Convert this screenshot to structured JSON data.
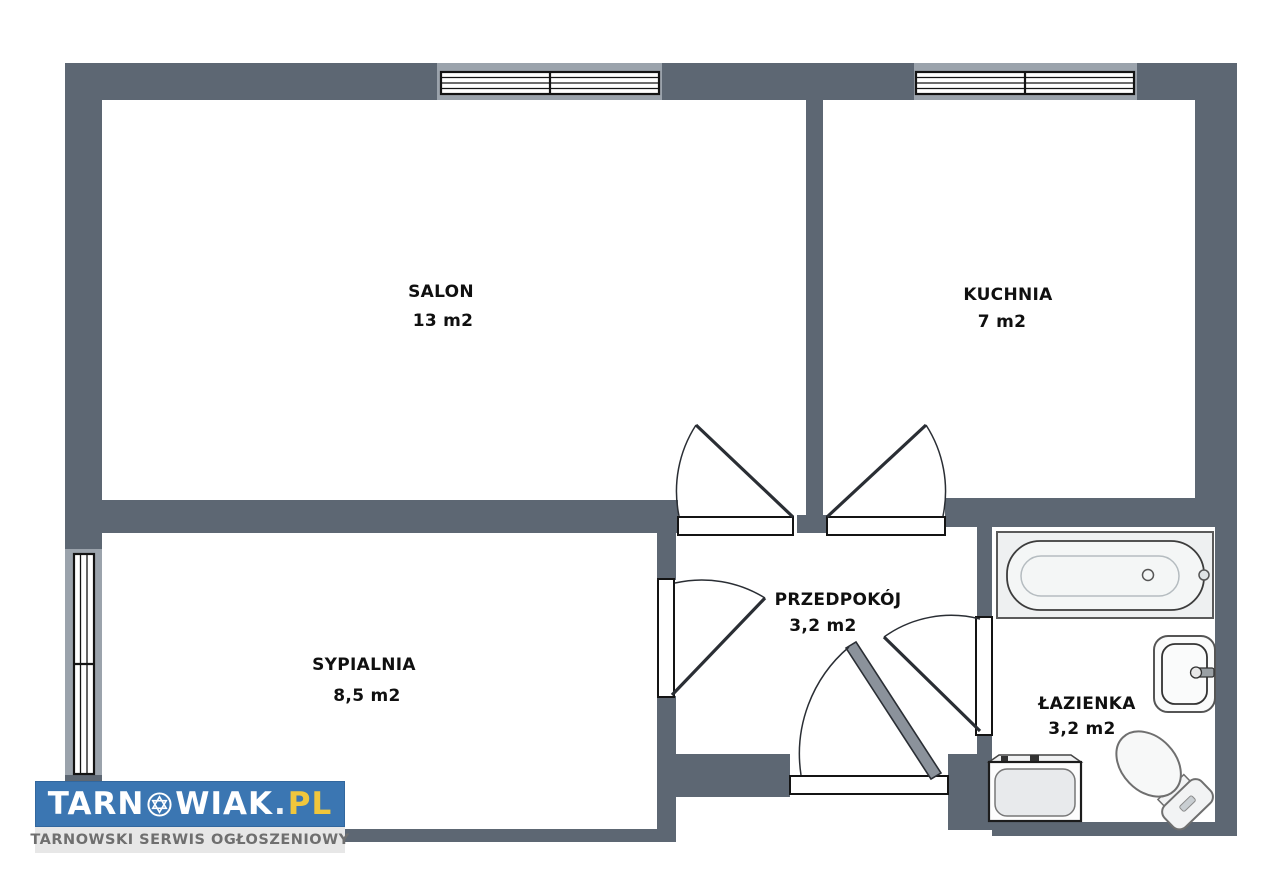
{
  "document_type": "apartment floor plan",
  "colors": {
    "wall": "#5d6773",
    "wall_window_reveal": "#9ba3ac",
    "background": "#ffffff",
    "line": "#1c1c1c",
    "fixture_fill": "#f2f4f4",
    "logo_blue": "#3b76b2",
    "logo_yellow": "#f0c63c",
    "logo_gray_bar": "#e7e7e7"
  },
  "rooms": [
    {
      "name": "SALON",
      "area": "13 m2"
    },
    {
      "name": "KUCHNIA",
      "area": "7 m2"
    },
    {
      "name": "SYPIALNIA",
      "area": "8,5 m2"
    },
    {
      "name": "PRZEDPOKÓJ",
      "area": "3,2 m2"
    },
    {
      "name": "ŁAZIENKA",
      "area": "3,2 m2"
    }
  ],
  "fixtures": [
    "bathtub",
    "washbasin",
    "washing-machine",
    "toilet"
  ],
  "openings": {
    "windows": 3,
    "interior_doors": 4,
    "entrance_doors": 1
  },
  "logo": {
    "brand_start": "TARN",
    "brand_end": "WIAK",
    "separator": ".",
    "tld": "PL",
    "tagline": "TARNOWSKI SERWIS OGŁOSZENIOWY"
  }
}
